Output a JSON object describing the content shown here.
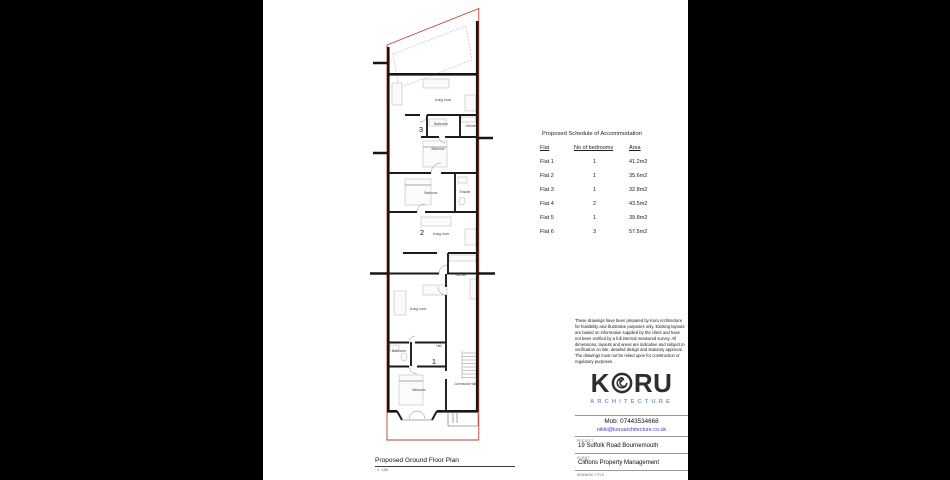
{
  "colors": {
    "boundary": "#c23b2f",
    "wall": "#161616",
    "logo_accent": "#7d99bd",
    "email_link": "#3a3ac9"
  },
  "plan": {
    "view_title": "Proposed Ground Floor Plan",
    "view_scale": "1 : 100",
    "room_labels": [
      {
        "text": "Living room",
        "x": 78,
        "y": 98
      },
      {
        "text": "Bathroom",
        "x": 76,
        "y": 122
      },
      {
        "text": "Kitchen",
        "x": 106,
        "y": 124
      },
      {
        "text": "Bedroom",
        "x": 73,
        "y": 147
      },
      {
        "text": "Bedroom",
        "x": 66,
        "y": 191
      },
      {
        "text": "Ensuite",
        "x": 100,
        "y": 190
      },
      {
        "text": "Living room",
        "x": 76,
        "y": 232
      },
      {
        "text": "Kitchen",
        "x": 96,
        "y": 273
      },
      {
        "text": "Living room",
        "x": 53,
        "y": 307
      },
      {
        "text": "Bathroom",
        "x": 34,
        "y": 349
      },
      {
        "text": "Hall",
        "x": 74,
        "y": 344
      },
      {
        "text": "Bedroom",
        "x": 54,
        "y": 388
      },
      {
        "text": "Communal Hall",
        "x": 100,
        "y": 382
      }
    ],
    "flat_numbers": [
      {
        "text": "3",
        "x": 56,
        "y": 129
      },
      {
        "text": "2",
        "x": 57,
        "y": 232
      },
      {
        "text": "1",
        "x": 69,
        "y": 361
      }
    ]
  },
  "schedule": {
    "title": "Proposed Schedule of Accommodation",
    "columns": [
      "Flat",
      "No of bedrooms",
      "Area"
    ],
    "rows": [
      {
        "flat": "Flat 1",
        "bedrooms": "1",
        "area": "41.2m2"
      },
      {
        "flat": "Flat 2",
        "bedrooms": "1",
        "area": "35.6m2"
      },
      {
        "flat": "Flat 3",
        "bedrooms": "1",
        "area": "32.8m2"
      },
      {
        "flat": "Flat 4",
        "bedrooms": "2",
        "area": "43.5m2"
      },
      {
        "flat": "Flat 5",
        "bedrooms": "1",
        "area": "39.8m2"
      },
      {
        "flat": "Flat 6",
        "bedrooms": "3",
        "area": "57.5m2"
      }
    ]
  },
  "notes": {
    "disclaimer": "These drawings have been prepared by Koru Architecture for feasibility and illustrative purposes only. Existing layouts are based on information supplied by the client and have not been verified by a full internal measured survey. All dimensions, layouts and areas are indicative and subject to verification on site, detailed design and statutory approval. The drawings must not be relied upon for construction or regulatory purposes."
  },
  "titleblock": {
    "logo_text_left": "K",
    "logo_text_right": "RU",
    "logo_subtext": "ARCHITECTURE",
    "mobile": "Mob: 07443534668",
    "email": "nikki@koruarchitecture.co.uk",
    "project_label": "PROJECT",
    "project_value": "19 Suffolk Road Bournemouth",
    "client_label": "CLIENT",
    "client_value": "Cliftons Property Management",
    "drawing_title_label": "DRAWING TITLE"
  }
}
